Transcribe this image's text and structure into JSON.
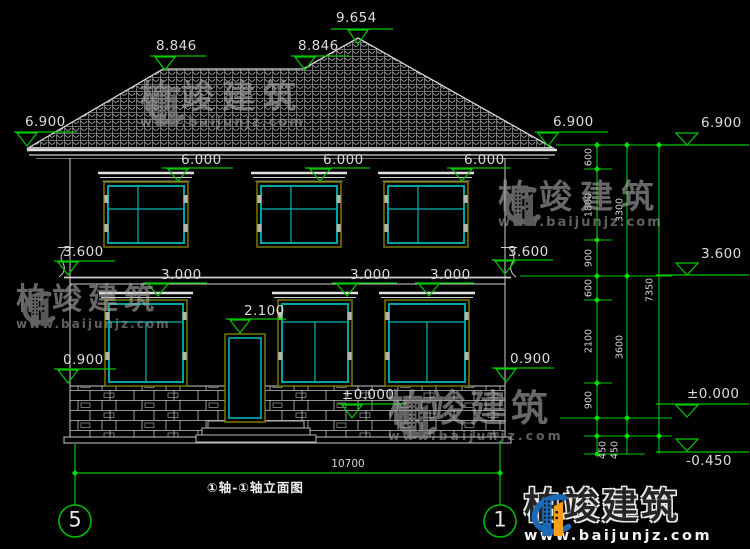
{
  "title_block": {
    "drawing_title": "①轴-①轴立面图"
  },
  "axis_bubbles": {
    "left": "5",
    "right": "1"
  },
  "watermark": {
    "brand": "柏竣建筑",
    "url": "www.baijunjz.com"
  },
  "footer_logo": {
    "brand": "柏竣建筑",
    "url": "www.baijunjz.com"
  },
  "elevation_markers": {
    "ridge": "9.654",
    "hip_left": "8.846",
    "hip_right": "8.846",
    "eave_left": "6.900",
    "eave_right": "6.900",
    "eave_far_right": "6.900",
    "win2f_1": "6.000",
    "win2f_2": "6.000",
    "win2f_3": "6.000",
    "floor2_left": "3.600",
    "floor2_right": "3.600",
    "floor2_far_right": "3.600",
    "win1f_1": "3.000",
    "win1f_2": "3.000",
    "win1f_3": "3.000",
    "door_head": "2.100",
    "sill_left": "0.900",
    "sill_right": "0.900",
    "ground_center": "±0.000",
    "ground_far_right": "±0.000",
    "grade": "-0.450"
  },
  "dimensions": {
    "overall_width": "10700",
    "vertical_chain": [
      "600",
      "1800",
      "900",
      "600",
      "2100",
      "900",
      "450",
      "450"
    ],
    "vertical_totals": [
      "3300",
      "3600",
      "7350"
    ]
  },
  "colors": {
    "background": "#000000",
    "dimension_green": "#00c800",
    "line_white": "#d8d8d8",
    "window_cyan": "#00b4b4",
    "frame_olive": "#8a8a00",
    "logo_blue": "#1b6ab5",
    "logo_orange": "#f59e1c"
  }
}
